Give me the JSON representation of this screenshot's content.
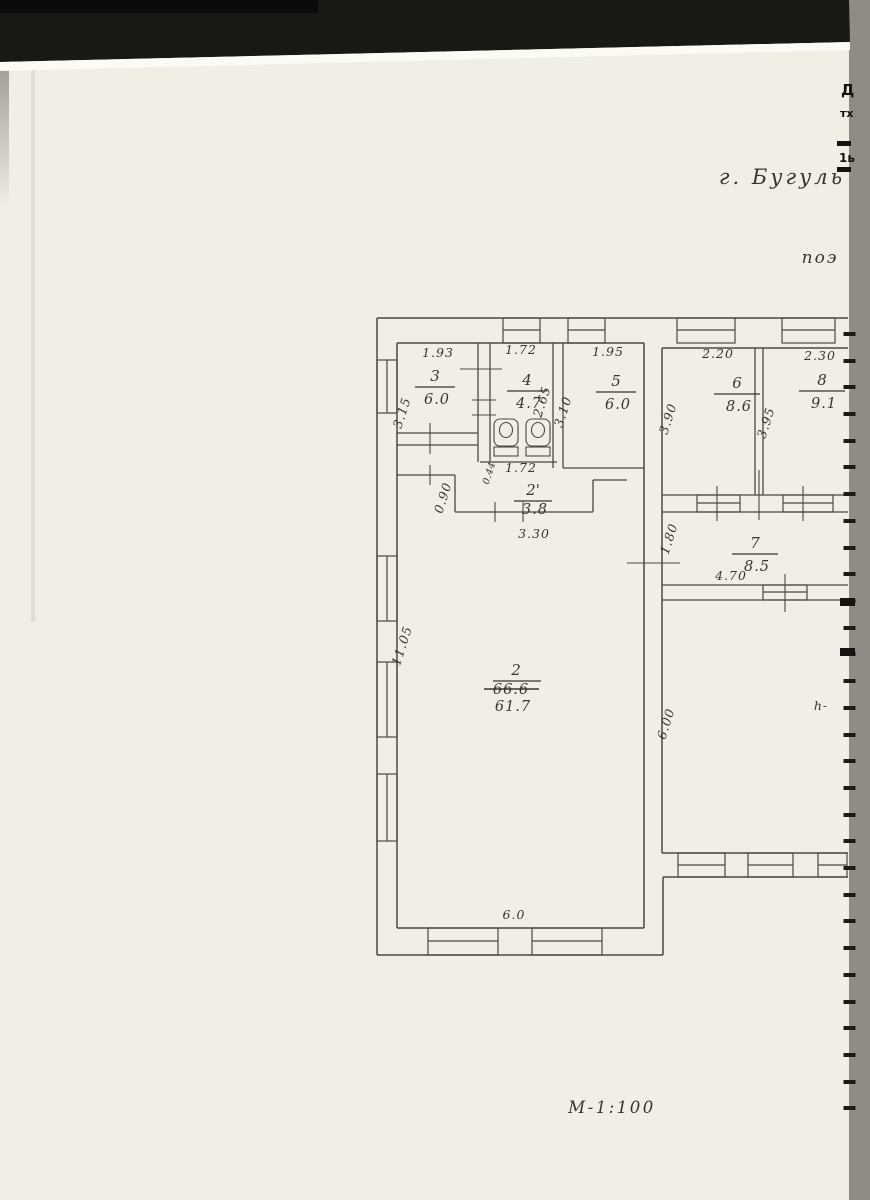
{
  "notes": {
    "city": "г. Бугуль",
    "plan_word": "поэ",
    "scale": "М-1:100"
  },
  "edge_fragments": {
    "f1": "Д",
    "f2": "тх",
    "f3": "1ь"
  },
  "rooms": {
    "r2": {
      "number": "2",
      "area_old": "66.6",
      "area": "61.7"
    },
    "r2a": {
      "number": "2'",
      "area": "3.8"
    },
    "r3": {
      "number": "3",
      "area": "6.0"
    },
    "r4": {
      "number": "4",
      "area": "4.7"
    },
    "r5": {
      "number": "5",
      "area": "6.0"
    },
    "r6": {
      "number": "6",
      "area": "8.6"
    },
    "r7": {
      "number": "7",
      "area": "8.5"
    },
    "r8": {
      "number": "8",
      "area": "9.1"
    }
  },
  "dims": {
    "w3": "1.93",
    "w4": "1.72",
    "w5": "1.95",
    "w6": "2.20",
    "w8": "2.30",
    "h3": "3.15",
    "h4": "2.65",
    "h5": "3.10",
    "h6": "3.90",
    "h8": "3.95",
    "niche_w": "1.72",
    "niche_small": "0.44",
    "niche_step": "0.90",
    "corridor": "3.30",
    "h7": "1.80",
    "w7": "4.70",
    "big_h": "11.05",
    "big_w": "6.0",
    "right_h": "6.00",
    "height_note": "h-"
  },
  "colors": {
    "paper": "#f1eee6",
    "scanner_bg": "#8e8c83",
    "top_band": "#191814",
    "ink": "#4d4941",
    "hand_ink": "#38352e"
  }
}
